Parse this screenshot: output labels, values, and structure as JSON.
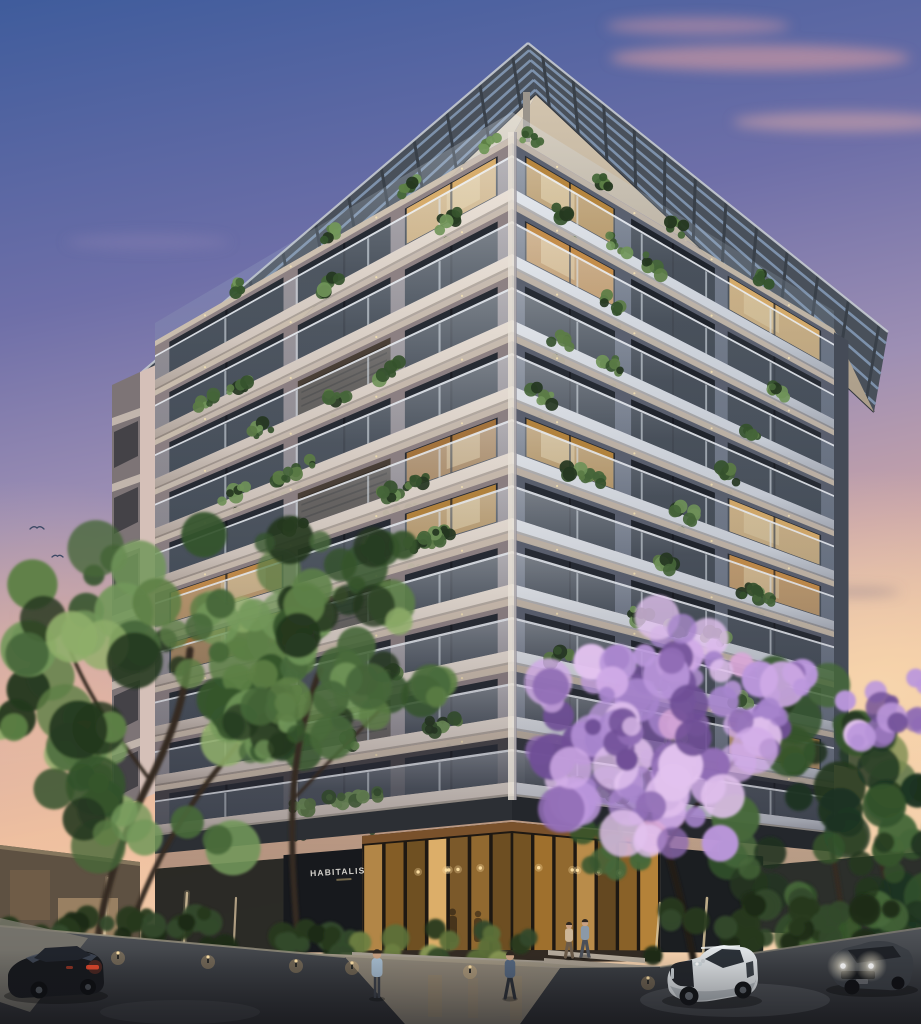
{
  "scene": {
    "description": "Ten-storey residential apartment tower at dusk, corner view, slatted roof pergola, planted balconies, glowing double-height lobby, street with trees, jacaranda in bloom, cars and pedestrians",
    "time_of_day": "dusk",
    "sign": {
      "text": "HABITALIS"
    },
    "sky": {
      "top": "#3f5c9c",
      "mid": "#9d8fb4",
      "horizon_left": "#eec0a0",
      "horizon_right": "#f6d2ae",
      "cloud_pink": "#e6a3a2"
    },
    "building": {
      "floors": 10,
      "wall_left": "#8f8385",
      "wall_right": "#5b6170",
      "slab_left_hi": "#ebe2d8",
      "slab_left_lo": "#c9beb5",
      "slab_right_hi": "#e4e8ed",
      "slab_right_lo": "#c3c9d3",
      "soffit_left": "#d9cdba",
      "soffit_right": "#c9bca8",
      "window_dark": "#262b33",
      "window_lit": [
        "#c9913f",
        "#d99a4e",
        "#edbd72",
        "#b87f3e"
      ],
      "louvre": "#4a4036",
      "glass_balustrade": "#c6d4e2",
      "pergola_frame": "#49505a",
      "pergola_slat": "#8aa2c0",
      "downlight": "#f7e6b8"
    },
    "lobby": {
      "glow_bright": "#f0bd72",
      "glow_mid": "#c9913f",
      "frame": "#1e1812",
      "wood_ceiling": "#8a5c30",
      "pendant": "#ffe2a4"
    },
    "vegetation": {
      "tree_greens": [
        "#24371f",
        "#35542c",
        "#47683a",
        "#5d7f46",
        "#72975a"
      ],
      "tree_warm_lit": "#8fae6a",
      "jacaranda": [
        "#8f6cb4",
        "#a684cc",
        "#bb97dc",
        "#cfaae6",
        "#e2c2ee",
        "#6f4f96"
      ],
      "hedge": [
        "#1c2b18",
        "#27391f",
        "#33492a"
      ],
      "trunk_dark": "#342a22",
      "trunk_lit": "#d8c09a"
    },
    "street": {
      "asphalt_top": "#515459",
      "asphalt_bottom": "#26272b",
      "sidewalk": "#9a9180",
      "curb": "#97917f",
      "bollard_glow": "#f5c47e"
    },
    "vehicles": [
      {
        "name": "black-sedan",
        "color": "#16181c",
        "lights": "taillights-red"
      },
      {
        "name": "white-suv",
        "color": "#dde1e4",
        "lights": "off"
      },
      {
        "name": "dark-suv",
        "color": "#3a3e44",
        "lights": "headlights-on"
      }
    ],
    "people_count": 4,
    "birds_count": 2
  }
}
